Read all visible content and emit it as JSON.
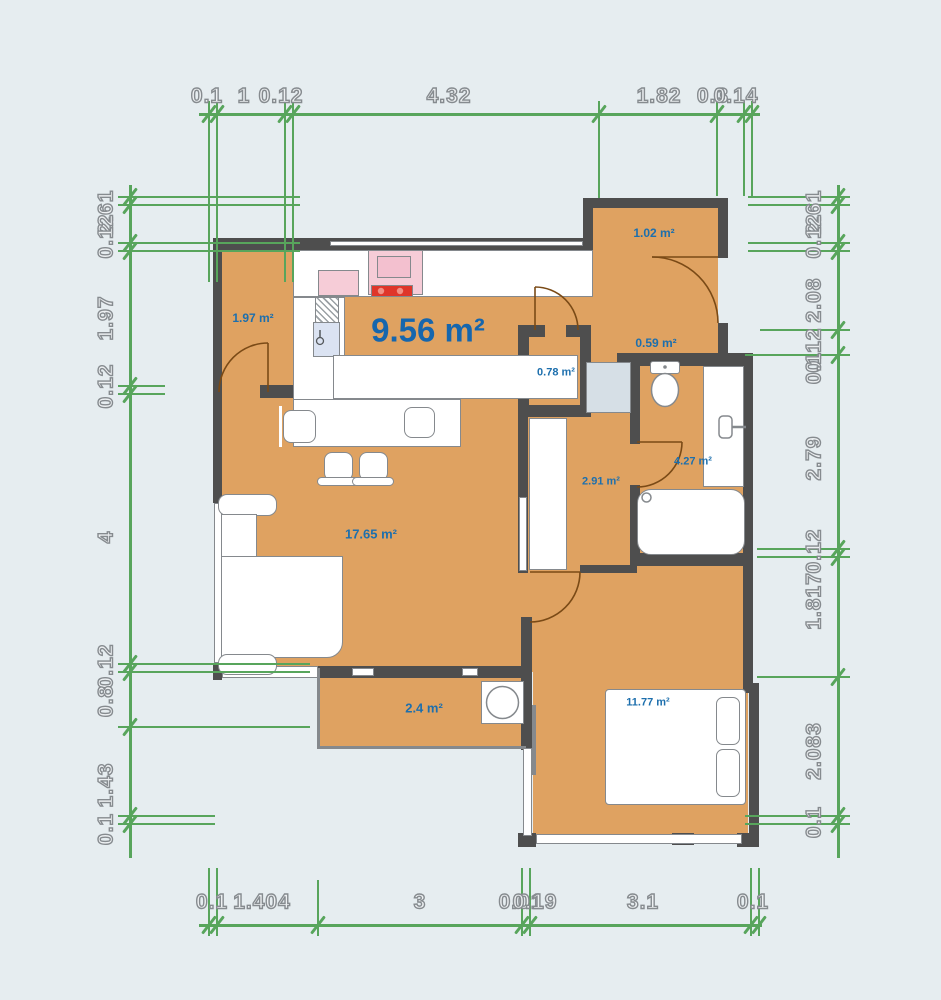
{
  "title": "floor-plan",
  "palette": {
    "background": "#e6edf0",
    "floor": "#dfa261",
    "wall": "#4e4e4e",
    "dimension_green": "#58a55c",
    "dimension_text_fill": "#edf0f2",
    "dimension_text_stroke": "#868b8f",
    "room_label_blue": "#1d6fad",
    "big_label_blue": "#1666ad",
    "furniture_border": "#85898d",
    "stove_pink": "#f6ccd7",
    "cooktop_red": "#df362a",
    "sink_blue": "#dbe3f2",
    "duct_blue": "#d6dfe6",
    "door_brown": "#7a4a16"
  },
  "rooms": [
    {
      "name": "entry",
      "label": "1.97 m²",
      "x": 253,
      "y": 318,
      "size": 12
    },
    {
      "name": "kitchen",
      "label": "9.56 m²",
      "x": 428,
      "y": 330,
      "size": 33
    },
    {
      "name": "loggia-top",
      "label": "1.02 m²",
      "x": 654,
      "y": 233,
      "size": 12
    },
    {
      "name": "hall",
      "label": "0.59 m²",
      "x": 656,
      "y": 343,
      "size": 12
    },
    {
      "name": "closet",
      "label": "0.78 m²",
      "x": 556,
      "y": 373,
      "size": 11
    },
    {
      "name": "bathroom",
      "label": "4.27 m²",
      "x": 693,
      "y": 462,
      "size": 11
    },
    {
      "name": "corridor",
      "label": "2.91 m²",
      "x": 601,
      "y": 482,
      "size": 11
    },
    {
      "name": "living-room",
      "label": "17.65 m²",
      "x": 371,
      "y": 534,
      "size": 13
    },
    {
      "name": "balcony",
      "label": "2.4 m²",
      "x": 424,
      "y": 708,
      "size": 13
    },
    {
      "name": "bedroom",
      "label": "11.77 m²",
      "x": 648,
      "y": 703,
      "size": 11
    }
  ],
  "floors": [
    {
      "x": 222,
      "y": 244,
      "w": 371,
      "h": 428
    },
    {
      "x": 593,
      "y": 206,
      "w": 125,
      "h": 51
    },
    {
      "x": 590,
      "y": 250,
      "w": 128,
      "h": 110
    },
    {
      "x": 518,
      "y": 327,
      "w": 112,
      "h": 246
    },
    {
      "x": 630,
      "y": 358,
      "w": 113,
      "h": 205
    },
    {
      "x": 533,
      "y": 563,
      "w": 215,
      "h": 277
    },
    {
      "x": 318,
      "y": 668,
      "w": 204,
      "h": 80
    }
  ],
  "walls": [
    {
      "x": 217,
      "y": 238,
      "w": 376,
      "h": 12
    },
    {
      "x": 583,
      "y": 198,
      "w": 10,
      "h": 52
    },
    {
      "x": 583,
      "y": 198,
      "w": 145,
      "h": 10
    },
    {
      "x": 718,
      "y": 198,
      "w": 10,
      "h": 60
    },
    {
      "x": 718,
      "y": 323,
      "w": 10,
      "h": 36
    },
    {
      "x": 617,
      "y": 353,
      "w": 136,
      "h": 13
    },
    {
      "x": 743,
      "y": 358,
      "w": 10,
      "h": 208
    },
    {
      "x": 630,
      "y": 553,
      "w": 123,
      "h": 13
    },
    {
      "x": 630,
      "y": 366,
      "w": 10,
      "h": 78
    },
    {
      "x": 630,
      "y": 485,
      "w": 10,
      "h": 68
    },
    {
      "x": 213,
      "y": 238,
      "w": 9,
      "h": 265
    },
    {
      "x": 213,
      "y": 663,
      "w": 9,
      "h": 17
    },
    {
      "x": 260,
      "y": 385,
      "w": 33,
      "h": 13
    },
    {
      "x": 518,
      "y": 325,
      "w": 27,
      "h": 12
    },
    {
      "x": 566,
      "y": 325,
      "w": 25,
      "h": 12
    },
    {
      "x": 518,
      "y": 325,
      "w": 11,
      "h": 92
    },
    {
      "x": 580,
      "y": 325,
      "w": 11,
      "h": 92
    },
    {
      "x": 518,
      "y": 405,
      "w": 73,
      "h": 12
    },
    {
      "x": 518,
      "y": 417,
      "w": 10,
      "h": 156
    },
    {
      "x": 521,
      "y": 617,
      "w": 11,
      "h": 51
    },
    {
      "x": 521,
      "y": 666,
      "w": 11,
      "h": 84
    },
    {
      "x": 518,
      "y": 833,
      "w": 18,
      "h": 14
    },
    {
      "x": 743,
      "y": 563,
      "w": 10,
      "h": 122
    },
    {
      "x": 743,
      "y": 683,
      "w": 16,
      "h": 10
    },
    {
      "x": 749,
      "y": 690,
      "w": 10,
      "h": 157
    },
    {
      "x": 737,
      "y": 833,
      "w": 22,
      "h": 14
    },
    {
      "x": 580,
      "y": 565,
      "w": 57,
      "h": 8
    },
    {
      "x": 318,
      "y": 666,
      "w": 204,
      "h": 12
    },
    {
      "x": 672,
      "y": 833,
      "w": 22,
      "h": 12
    }
  ],
  "windows": [
    {
      "x": 214,
      "y": 503,
      "w": 8,
      "h": 160
    },
    {
      "x": 330,
      "y": 241,
      "w": 253,
      "h": 5
    },
    {
      "x": 519,
      "y": 497,
      "w": 8,
      "h": 74
    },
    {
      "x": 523,
      "y": 748,
      "w": 9,
      "h": 88
    },
    {
      "x": 536,
      "y": 834,
      "w": 206,
      "h": 10
    },
    {
      "x": 222,
      "y": 666,
      "w": 96,
      "h": 12
    },
    {
      "x": 352,
      "y": 668,
      "w": 22,
      "h": 8
    },
    {
      "x": 462,
      "y": 668,
      "w": 16,
      "h": 8
    }
  ],
  "thin_lines": [
    {
      "x": 317,
      "y": 668,
      "w": 3,
      "h": 81
    },
    {
      "x": 317,
      "y": 746,
      "w": 209,
      "h": 3
    },
    {
      "x": 532,
      "y": 705,
      "w": 4,
      "h": 70
    }
  ],
  "furniture": [
    {
      "name": "sofa-armrest",
      "x": 218,
      "y": 494,
      "w": 59,
      "h": 22,
      "r": "9px"
    },
    {
      "name": "sofa-back",
      "x": 221,
      "y": 514,
      "w": 36,
      "h": 74
    },
    {
      "name": "sofa-back",
      "x": 221,
      "y": 590,
      "w": 36,
      "h": 68
    },
    {
      "name": "sofa-seat",
      "x": 221,
      "y": 556,
      "w": 122,
      "h": 102,
      "r": "0 0 16px 0"
    },
    {
      "name": "sofa-armrest",
      "x": 218,
      "y": 654,
      "w": 59,
      "h": 21,
      "r": "9px"
    },
    {
      "name": "kitchen-counter",
      "x": 293,
      "y": 250,
      "w": 300,
      "h": 47
    },
    {
      "name": "counter-divider",
      "x": 337,
      "y": 252,
      "w": 2,
      "h": 43,
      "cls": "thin noborder"
    },
    {
      "name": "counter-divider",
      "x": 423,
      "y": 252,
      "w": 2,
      "h": 43,
      "cls": "thin noborder"
    },
    {
      "name": "counter-divider",
      "x": 461,
      "y": 252,
      "w": 2,
      "h": 43,
      "cls": "thin noborder"
    },
    {
      "name": "stove",
      "x": 368,
      "y": 250,
      "w": 55,
      "h": 45,
      "fill": "#f6ccd7"
    },
    {
      "name": "stove-top",
      "x": 377,
      "y": 256,
      "w": 34,
      "h": 22,
      "fill": "#f3c0cf"
    },
    {
      "name": "cooktop",
      "x": 371,
      "y": 285,
      "w": 42,
      "h": 12,
      "fill": "#df362a"
    },
    {
      "name": "small-appliance",
      "x": 318,
      "y": 270,
      "w": 41,
      "h": 26,
      "fill": "#f6ccd7"
    },
    {
      "name": "kitchen-counter",
      "x": 293,
      "y": 297,
      "w": 52,
      "h": 150
    },
    {
      "name": "dishwasher",
      "x": 315,
      "y": 297,
      "w": 24,
      "h": 38,
      "cls": "hatch"
    },
    {
      "name": "kitchen-sink",
      "x": 313,
      "y": 322,
      "w": 27,
      "h": 35,
      "fill": "#dbe3f2"
    },
    {
      "name": "kitchen-island",
      "x": 333,
      "y": 355,
      "w": 245,
      "h": 44
    },
    {
      "name": "kitchen-island",
      "x": 293,
      "y": 399,
      "w": 168,
      "h": 48
    },
    {
      "name": "stool",
      "x": 283,
      "y": 410,
      "w": 33,
      "h": 33,
      "r": "8px"
    },
    {
      "name": "stool-rail",
      "x": 279,
      "y": 406,
      "w": 3,
      "h": 41,
      "cls": "thin noborder"
    },
    {
      "name": "stool",
      "x": 404,
      "y": 407,
      "w": 31,
      "h": 31,
      "r": "8px"
    },
    {
      "name": "stool-rail",
      "x": 437,
      "y": 403,
      "w": 3,
      "h": 41,
      "cls": "thin noborder"
    },
    {
      "name": "stool",
      "x": 324,
      "y": 452,
      "w": 29,
      "h": 29,
      "r": "8px"
    },
    {
      "name": "stool",
      "x": 359,
      "y": 452,
      "w": 29,
      "h": 29,
      "r": "8px"
    },
    {
      "name": "stool-rail",
      "x": 317,
      "y": 477,
      "w": 42,
      "h": 9,
      "r": "5px"
    },
    {
      "name": "stool-rail",
      "x": 352,
      "y": 477,
      "w": 42,
      "h": 9,
      "r": "5px"
    },
    {
      "name": "wardrobe",
      "x": 529,
      "y": 418,
      "w": 38,
      "h": 152
    },
    {
      "name": "duct-shaft",
      "x": 586,
      "y": 362,
      "w": 45,
      "h": 51,
      "fill": "#d6dfe6"
    },
    {
      "name": "toilet-tank",
      "x": 650,
      "y": 361,
      "w": 30,
      "h": 13,
      "r": "3px"
    },
    {
      "name": "vanity",
      "x": 703,
      "y": 366,
      "w": 41,
      "h": 121
    },
    {
      "name": "vanity-divider",
      "x": 733,
      "y": 368,
      "w": 2,
      "h": 117,
      "cls": "thin noborder"
    },
    {
      "name": "bathtub",
      "x": 637,
      "y": 489,
      "w": 108,
      "h": 66,
      "r": "14px"
    },
    {
      "name": "washing-machine",
      "x": 481,
      "y": 681,
      "w": 43,
      "h": 43
    },
    {
      "name": "bed",
      "x": 605,
      "y": 689,
      "w": 141,
      "h": 116,
      "r": "4px"
    },
    {
      "name": "pillow",
      "x": 716,
      "y": 697,
      "w": 24,
      "h": 48,
      "r": "7px"
    },
    {
      "name": "pillow",
      "x": 716,
      "y": 749,
      "w": 24,
      "h": 48,
      "r": "7px"
    }
  ],
  "doors": [
    {
      "name": "entry-door",
      "leaf": "M268,343 L268,392",
      "arc": "M268,343 A49,49 0 0 0 219,392"
    },
    {
      "name": "kitchen-hall-door",
      "leaf": "M535,287 L535,330",
      "arc": "M535,287 A43,43 0 0 1 578,330"
    },
    {
      "name": "loggia-door",
      "leaf": "M652,257 L718,257",
      "arc": "M652,257 A66,66 0 0 1 718,323"
    },
    {
      "name": "bathroom-door",
      "leaf": "M637,442 L682,442",
      "arc": "M682,442 A45,45 0 0 1 637,487"
    },
    {
      "name": "bedroom-door",
      "leaf": "M530,572 L580,572",
      "arc": "M580,572 A50,50 0 0 1 530,622"
    }
  ],
  "svg_circles": [
    {
      "name": "toilet-button",
      "cx": 665,
      "cy": 367,
      "r": 1.8,
      "fill": "#85898d",
      "stroke": "none",
      "sw": 0
    },
    {
      "name": "washer-drum",
      "cx": 502.5,
      "cy": 702.5,
      "r": 16,
      "fill": "#ffffff",
      "stroke": "#85898d",
      "sw": 1.5
    },
    {
      "name": "tub-drain",
      "cx": 646.5,
      "cy": 497.5,
      "r": 4.5,
      "fill": "none",
      "stroke": "#85898d",
      "sw": 1.5
    },
    {
      "name": "sink-faucet",
      "cx": 320,
      "cy": 341,
      "r": 3.5,
      "fill": "#dbe3f2",
      "stroke": "#55595c",
      "sw": 1.3
    },
    {
      "name": "cooktop-knob",
      "cx": 381,
      "cy": 291,
      "r": 3.2,
      "fill": "#f19084",
      "stroke": "none",
      "sw": 0
    },
    {
      "name": "cooktop-knob",
      "cx": 400,
      "cy": 291,
      "r": 3.2,
      "fill": "#f19084",
      "stroke": "none",
      "sw": 0
    }
  ],
  "svg_ellipses": [
    {
      "name": "toilet-bowl",
      "cx": 665,
      "cy": 390,
      "rx": 13.5,
      "ry": 16.5,
      "fill": "#ffffff",
      "stroke": "#85898d",
      "sw": 1.5
    }
  ],
  "svg_lines": [
    {
      "name": "vanity-handle",
      "x1": 732,
      "y1": 427,
      "x2": 746,
      "y2": 427,
      "stroke": "#85898d",
      "w": 2.5
    },
    {
      "name": "sink-spout",
      "x1": 320,
      "y1": 337,
      "x2": 320,
      "y2": 330,
      "stroke": "#55595c",
      "w": 1.5
    }
  ],
  "svg_rects": [
    {
      "name": "vanity-fixture",
      "x": 719,
      "y": 416,
      "w": 13,
      "h": 22,
      "rx": 4,
      "fill": "#ffffff",
      "stroke": "#85898d",
      "sw": 1.5
    }
  ],
  "dimensions": {
    "top": {
      "line": {
        "x": 199,
        "y": 113,
        "len": 561
      },
      "label_y": 96,
      "labels": [
        {
          "t": "0.1",
          "x": 207
        },
        {
          "t": "1",
          "x": 244
        },
        {
          "t": "0.12",
          "x": 281
        },
        {
          "t": "4.32",
          "x": 449
        },
        {
          "t": "1.82",
          "x": 659
        },
        {
          "t": "0.3",
          "x": 713
        },
        {
          "t": "0.14",
          "x": 736
        }
      ],
      "ticks": [
        {
          "p": 209,
          "g": 282
        },
        {
          "p": 217,
          "g": 282
        },
        {
          "p": 285,
          "g": 282
        },
        {
          "p": 293,
          "g": 282
        },
        {
          "p": 599,
          "g": 198
        },
        {
          "p": 717,
          "g": 196
        },
        {
          "p": 744,
          "g": 196
        },
        {
          "p": 752,
          "g": 196
        }
      ]
    },
    "bottom": {
      "line": {
        "x": 199,
        "y": 924,
        "len": 563
      },
      "label_y": 902,
      "labels": [
        {
          "t": "0.1",
          "x": 212
        },
        {
          "t": "1.404",
          "x": 262
        },
        {
          "t": "3",
          "x": 420
        },
        {
          "t": "0.01",
          "x": 521
        },
        {
          "t": "0.19",
          "x": 535
        },
        {
          "t": "3.1",
          "x": 643
        },
        {
          "t": "0.1",
          "x": 753
        }
      ],
      "ticks": [
        {
          "p": 209,
          "g": 868
        },
        {
          "p": 217,
          "g": 868
        },
        {
          "p": 318,
          "g": 880
        },
        {
          "p": 522,
          "g": 868
        },
        {
          "p": 530,
          "g": 868
        },
        {
          "p": 751,
          "g": 868
        },
        {
          "p": 759,
          "g": 868
        }
      ]
    },
    "left": {
      "line": {
        "x": 129,
        "y": 185,
        "len": 673
      },
      "label_x": 106,
      "labels": [
        {
          "t": "2.61",
          "y": 212
        },
        {
          "t": "0.12",
          "y": 236
        },
        {
          "t": "1.97",
          "y": 318
        },
        {
          "t": "0.12",
          "y": 386
        },
        {
          "t": "4",
          "y": 537
        },
        {
          "t": "0.12",
          "y": 666
        },
        {
          "t": "0.8",
          "y": 701
        },
        {
          "t": "1.43",
          "y": 785
        },
        {
          "t": "0.1",
          "y": 829
        }
      ],
      "ticks": [
        {
          "p": 197,
          "g": 300
        },
        {
          "p": 205,
          "g": 300
        },
        {
          "p": 243,
          "g": 300
        },
        {
          "p": 251,
          "g": 300
        },
        {
          "p": 386,
          "g": 165
        },
        {
          "p": 394,
          "g": 165
        },
        {
          "p": 664,
          "g": 310
        },
        {
          "p": 672,
          "g": 310
        },
        {
          "p": 727,
          "g": 310
        },
        {
          "p": 816,
          "g": 215
        },
        {
          "p": 824,
          "g": 215
        }
      ]
    },
    "right": {
      "line": {
        "x": 837,
        "y": 185,
        "len": 673
      },
      "label_x": 814,
      "labels": [
        {
          "t": "2.61",
          "y": 212
        },
        {
          "t": "0.12",
          "y": 236
        },
        {
          "t": "2.08",
          "y": 300
        },
        {
          "t": "0.12",
          "y": 350
        },
        {
          "t": "0.1",
          "y": 368
        },
        {
          "t": "2.79",
          "y": 458
        },
        {
          "t": "0.12",
          "y": 551
        },
        {
          "t": "1.817",
          "y": 601
        },
        {
          "t": "2.083",
          "y": 751
        },
        {
          "t": "0.1",
          "y": 822
        }
      ],
      "ticks": [
        {
          "p": 197,
          "g": 748
        },
        {
          "p": 205,
          "g": 748
        },
        {
          "p": 243,
          "g": 748
        },
        {
          "p": 251,
          "g": 748
        },
        {
          "p": 330,
          "g": 760
        },
        {
          "p": 355,
          "g": 745
        },
        {
          "p": 549,
          "g": 757
        },
        {
          "p": 557,
          "g": 757
        },
        {
          "p": 677,
          "g": 757
        },
        {
          "p": 816,
          "g": 745
        },
        {
          "p": 824,
          "g": 745
        }
      ]
    }
  }
}
